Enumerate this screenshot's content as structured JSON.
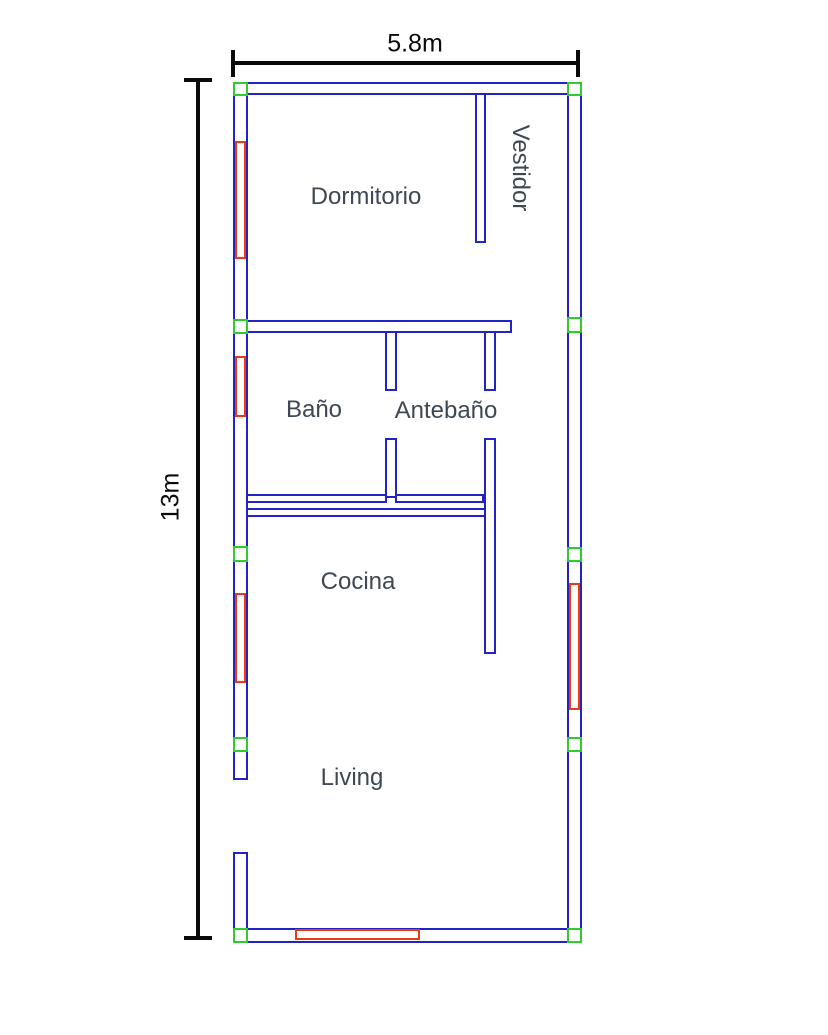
{
  "plan": {
    "title": "floor-plan",
    "width_label": "5.8m",
    "height_label": "13m"
  },
  "colors": {
    "wall": "#2222c5",
    "window": "#ee3a10",
    "marker": "#2ecc2e",
    "dimension": "#0a0a0a",
    "label": "#3e4852",
    "background": "#ffffff"
  },
  "rooms": [
    {
      "id": "dormitorio",
      "label": "Dormitorio",
      "cx": 366,
      "cy": 197,
      "rotate": 0
    },
    {
      "id": "vestidor",
      "label": "Vestidor",
      "cx": 520,
      "cy": 168,
      "rotate": 90
    },
    {
      "id": "bano",
      "label": "Baño",
      "cx": 314,
      "cy": 410,
      "rotate": 0
    },
    {
      "id": "antebano",
      "label": "Antebaño",
      "cx": 446,
      "cy": 411,
      "rotate": 0
    },
    {
      "id": "cocina",
      "label": "Cocina",
      "cx": 358,
      "cy": 582,
      "rotate": 0
    },
    {
      "id": "living",
      "label": "Living",
      "cx": 352,
      "cy": 778,
      "rotate": 0
    }
  ],
  "geometry": {
    "walls": [
      {
        "name": "top-exterior",
        "x": 233,
        "y": 82,
        "w": 349,
        "h": 13
      },
      {
        "name": "left-exterior-upper",
        "x": 233,
        "y": 82,
        "w": 15,
        "h": 698
      },
      {
        "name": "left-exterior-lower",
        "x": 233,
        "y": 852,
        "w": 15,
        "h": 91
      },
      {
        "name": "right-exterior",
        "x": 567,
        "y": 82,
        "w": 15,
        "h": 861
      },
      {
        "name": "bottom-exterior",
        "x": 233,
        "y": 928,
        "w": 349,
        "h": 15
      },
      {
        "name": "vestidor-partition",
        "x": 475,
        "y": 93,
        "w": 11,
        "h": 150
      },
      {
        "name": "bano-top",
        "x": 246,
        "y": 320,
        "w": 266,
        "h": 13
      },
      {
        "name": "bano-antebano-upper",
        "x": 385,
        "y": 331,
        "w": 12,
        "h": 60
      },
      {
        "name": "bano-antebano-lower",
        "x": 385,
        "y": 438,
        "w": 12,
        "h": 60
      },
      {
        "name": "antebano-hall-upper",
        "x": 484,
        "y": 331,
        "w": 12,
        "h": 60
      },
      {
        "name": "antebano-cocina",
        "x": 484,
        "y": 438,
        "w": 12,
        "h": 216
      },
      {
        "name": "bano-bottom-left",
        "x": 246,
        "y": 494,
        "w": 141,
        "h": 9
      },
      {
        "name": "bano-bottom-right",
        "x": 395,
        "y": 494,
        "w": 89,
        "h": 9
      },
      {
        "name": "cocina-top",
        "x": 246,
        "y": 508,
        "w": 240,
        "h": 9
      }
    ],
    "windows": [
      {
        "name": "dormitorio-window",
        "x": 235,
        "y": 141,
        "w": 11,
        "h": 118
      },
      {
        "name": "bano-window",
        "x": 235,
        "y": 356,
        "w": 11,
        "h": 61
      },
      {
        "name": "cocina-left-window",
        "x": 235,
        "y": 593,
        "w": 11,
        "h": 90
      },
      {
        "name": "cocina-right-window",
        "x": 569,
        "y": 583,
        "w": 11,
        "h": 127
      },
      {
        "name": "living-window",
        "x": 295,
        "y": 929,
        "w": 125,
        "h": 11
      }
    ],
    "markers": [
      {
        "name": "corner-top-left",
        "x": 233,
        "y": 82,
        "w": 15,
        "h": 14
      },
      {
        "name": "corner-top-right",
        "x": 567,
        "y": 82,
        "w": 15,
        "h": 14
      },
      {
        "name": "left-bano-junction",
        "x": 233,
        "y": 319,
        "w": 15,
        "h": 15
      },
      {
        "name": "right-bano-level",
        "x": 567,
        "y": 317,
        "w": 15,
        "h": 16
      },
      {
        "name": "left-cocina",
        "x": 233,
        "y": 546,
        "w": 15,
        "h": 16
      },
      {
        "name": "right-cocina",
        "x": 567,
        "y": 547,
        "w": 15,
        "h": 15
      },
      {
        "name": "left-living",
        "x": 233,
        "y": 737,
        "w": 15,
        "h": 15
      },
      {
        "name": "right-living",
        "x": 567,
        "y": 737,
        "w": 15,
        "h": 15
      },
      {
        "name": "corner-bottom-left",
        "x": 233,
        "y": 928,
        "w": 15,
        "h": 15
      },
      {
        "name": "corner-bottom-right",
        "x": 567,
        "y": 928,
        "w": 15,
        "h": 15
      }
    ]
  }
}
